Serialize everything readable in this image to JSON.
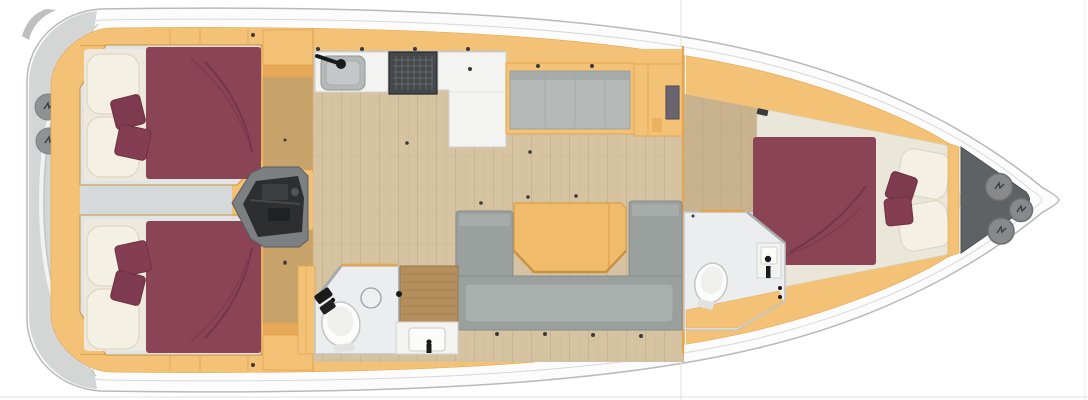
{
  "title": "Sailing yacht interior floor plan (top-down view, bow to the right)",
  "orientation": {
    "bow": "right",
    "stern": "left"
  },
  "counts": {
    "double_berths": 3,
    "heads": 2,
    "stern_hatches": 2,
    "bow_hatches": 3,
    "companionway_steps": 5,
    "throw_cushions_per_berth": 2
  },
  "components": [
    "hull",
    "stern-swim-platform",
    "stern-hatches",
    "aft-cabin-port",
    "aft-cabin-starboard",
    "engine-compartment",
    "companionway-stairs",
    "galley-sink",
    "galley-stove",
    "galley-cabinet",
    "salon-floor",
    "salon-bench",
    "tv-cabinet",
    "bulkhead",
    "salon-sofa-u",
    "salon-table",
    "aft-head-wet-room",
    "shower-teak-grate",
    "head-sink",
    "toilet",
    "mirror",
    "owners-cabin-forward",
    "forward-head",
    "bow-anchor-locker",
    "bow-hatches"
  ],
  "colors": {
    "bg": "#ffffff",
    "hull_fill": "#fcfcfc",
    "hull_stroke": "#b9b9b9",
    "hull_inner": "#d8d8d8",
    "stern_gray": "#d4d5d5",
    "stern_hatch": "#8f9193",
    "deck": "#f3c277",
    "deck_dark": "#e2a551",
    "deck_edge": "#c8913c",
    "cabin_floor": "#e0e4e5",
    "bed": "#8b4356",
    "bed_crease": "#6f3448",
    "pillow": "#f4f0e3",
    "pillow_edge": "#ddd6c2",
    "cushion": "#7e3a4e",
    "cushion_alt": "#843d52",
    "wood_floor": "#d6c3a2",
    "fwd_floor": "#c9b28e",
    "wardrobe_floor": "#c7a26a",
    "counter": "#f3f3f1",
    "counter_edge": "#d2d2d0",
    "sink": "#b4b9b9",
    "stove": "#45484b",
    "stove_grid": "#6e7477",
    "sofa": "#9aa09e",
    "sofa_inner": "#a9afad",
    "bench": "#b5bab8",
    "table": "#f1bb6c",
    "table_edge": "#d79e49",
    "head_floor": "#ebedee",
    "head_wall": "#bfc3c4",
    "teak": "#b48e5c",
    "engine_case": "#7d8082",
    "engine": "#2c2e30",
    "locker": "#5e6265",
    "hatch": "#87898b",
    "hatch_edge": "#6b6d6f",
    "fixture_black": "#1a1a1a",
    "latch": "#3a3a3a"
  }
}
